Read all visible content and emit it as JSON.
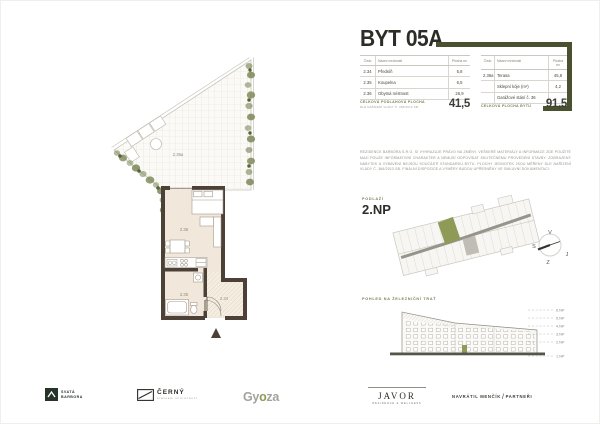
{
  "title": "BYT 05A",
  "table_headers": {
    "num": "Číslo",
    "name": "Název místnosti",
    "area": "Plocha m²"
  },
  "rooms_left": [
    {
      "num": "2.34",
      "name": "Předsíň",
      "area": "5,8"
    },
    {
      "num": "2.35",
      "name": "Koupelna",
      "area": "6,5"
    },
    {
      "num": "2.36",
      "name": "Obytná místnost",
      "area": "26,9"
    }
  ],
  "rooms_right": [
    {
      "num": "2.36a",
      "name": "Terasa",
      "area": "45,8"
    },
    {
      "num": "",
      "name": "Sklepní kóje (m²)",
      "area": "4,2"
    },
    {
      "num": "",
      "name": "Garážové stání č. 36",
      "area": ""
    }
  ],
  "totals": {
    "left_label": "CELKOVÁ PODLAHOVÁ PLOCHA",
    "left_sublabel": "DLE NAŘÍZENÍ VLÁDY Č. 366/2013 SB.",
    "left_value": "41,5",
    "right_label": "CELKOVÁ PLOCHA BYTU",
    "right_value": "91,5"
  },
  "disclaimer": "REZIDENCE BARBORA S.R.O. SI VYHRAZUJE PRÁVO NA ZMĚNY. VEŠKERÉ MATERIÁLY A INFORMACE ZDE POUŽITÉ MAJÍ POUZE INFORMATIVNÍ CHARAKTER A NEMUSÍ ODPOVÍDAT SKUTEČNÉMU PROVEDENÍ STAVBY. ZOBRAZENÝ NÁBYTEK A VYBAVENÍ NEJSOU SOUČÁSTÍ STANDARDU BYTU. PLOCHY JEDNOTEK JSOU MĚŘENY DLE NAŘÍZENÍ VLÁDY Č. 366/2013 SB. FINÁLNÍ DISPOZICE A VÝMĚRY BUDOU UPŘESNĚNY VE SMLUVNÍ DOKUMENTACI.",
  "floor": {
    "label": "PODLAŽÍ",
    "value": "2.NP"
  },
  "compass": {
    "top": "V",
    "left": "S",
    "right": "J",
    "bottom": "Z"
  },
  "elevation": {
    "label": "POHLED NA ŽELEZNIČNÍ TRAŤ",
    "levels": [
      "6.NP",
      "5.NP",
      "4.NP",
      "3.NP",
      "2.NP",
      "1.NP"
    ]
  },
  "plan": {
    "terrace": "2.36a",
    "living": "2.36",
    "bath": "2.35",
    "hall": "2.34"
  },
  "footer": {
    "barbora_line1": "SVATÁ",
    "barbora_line2": "BARBORA",
    "cerny": "ČERNÝ",
    "cerny_sub": "STAVEBNÍ SPOLEČNOST",
    "gyoza_a": "Gy",
    "gyoza_b": "o",
    "gyoza_c": "za",
    "javor": "JAVOR",
    "javor_sub": "REZIDENCE & WELLNESS",
    "partners_a": "NAVRÁTIL MENČÍK",
    "partners_slash": "/",
    "partners_b": "PARTNEŘI"
  },
  "colors": {
    "accent": "#4a5130",
    "highlight": "#8d9b57",
    "wall": "#4c4037",
    "floor_fill": "#f1e7da"
  }
}
